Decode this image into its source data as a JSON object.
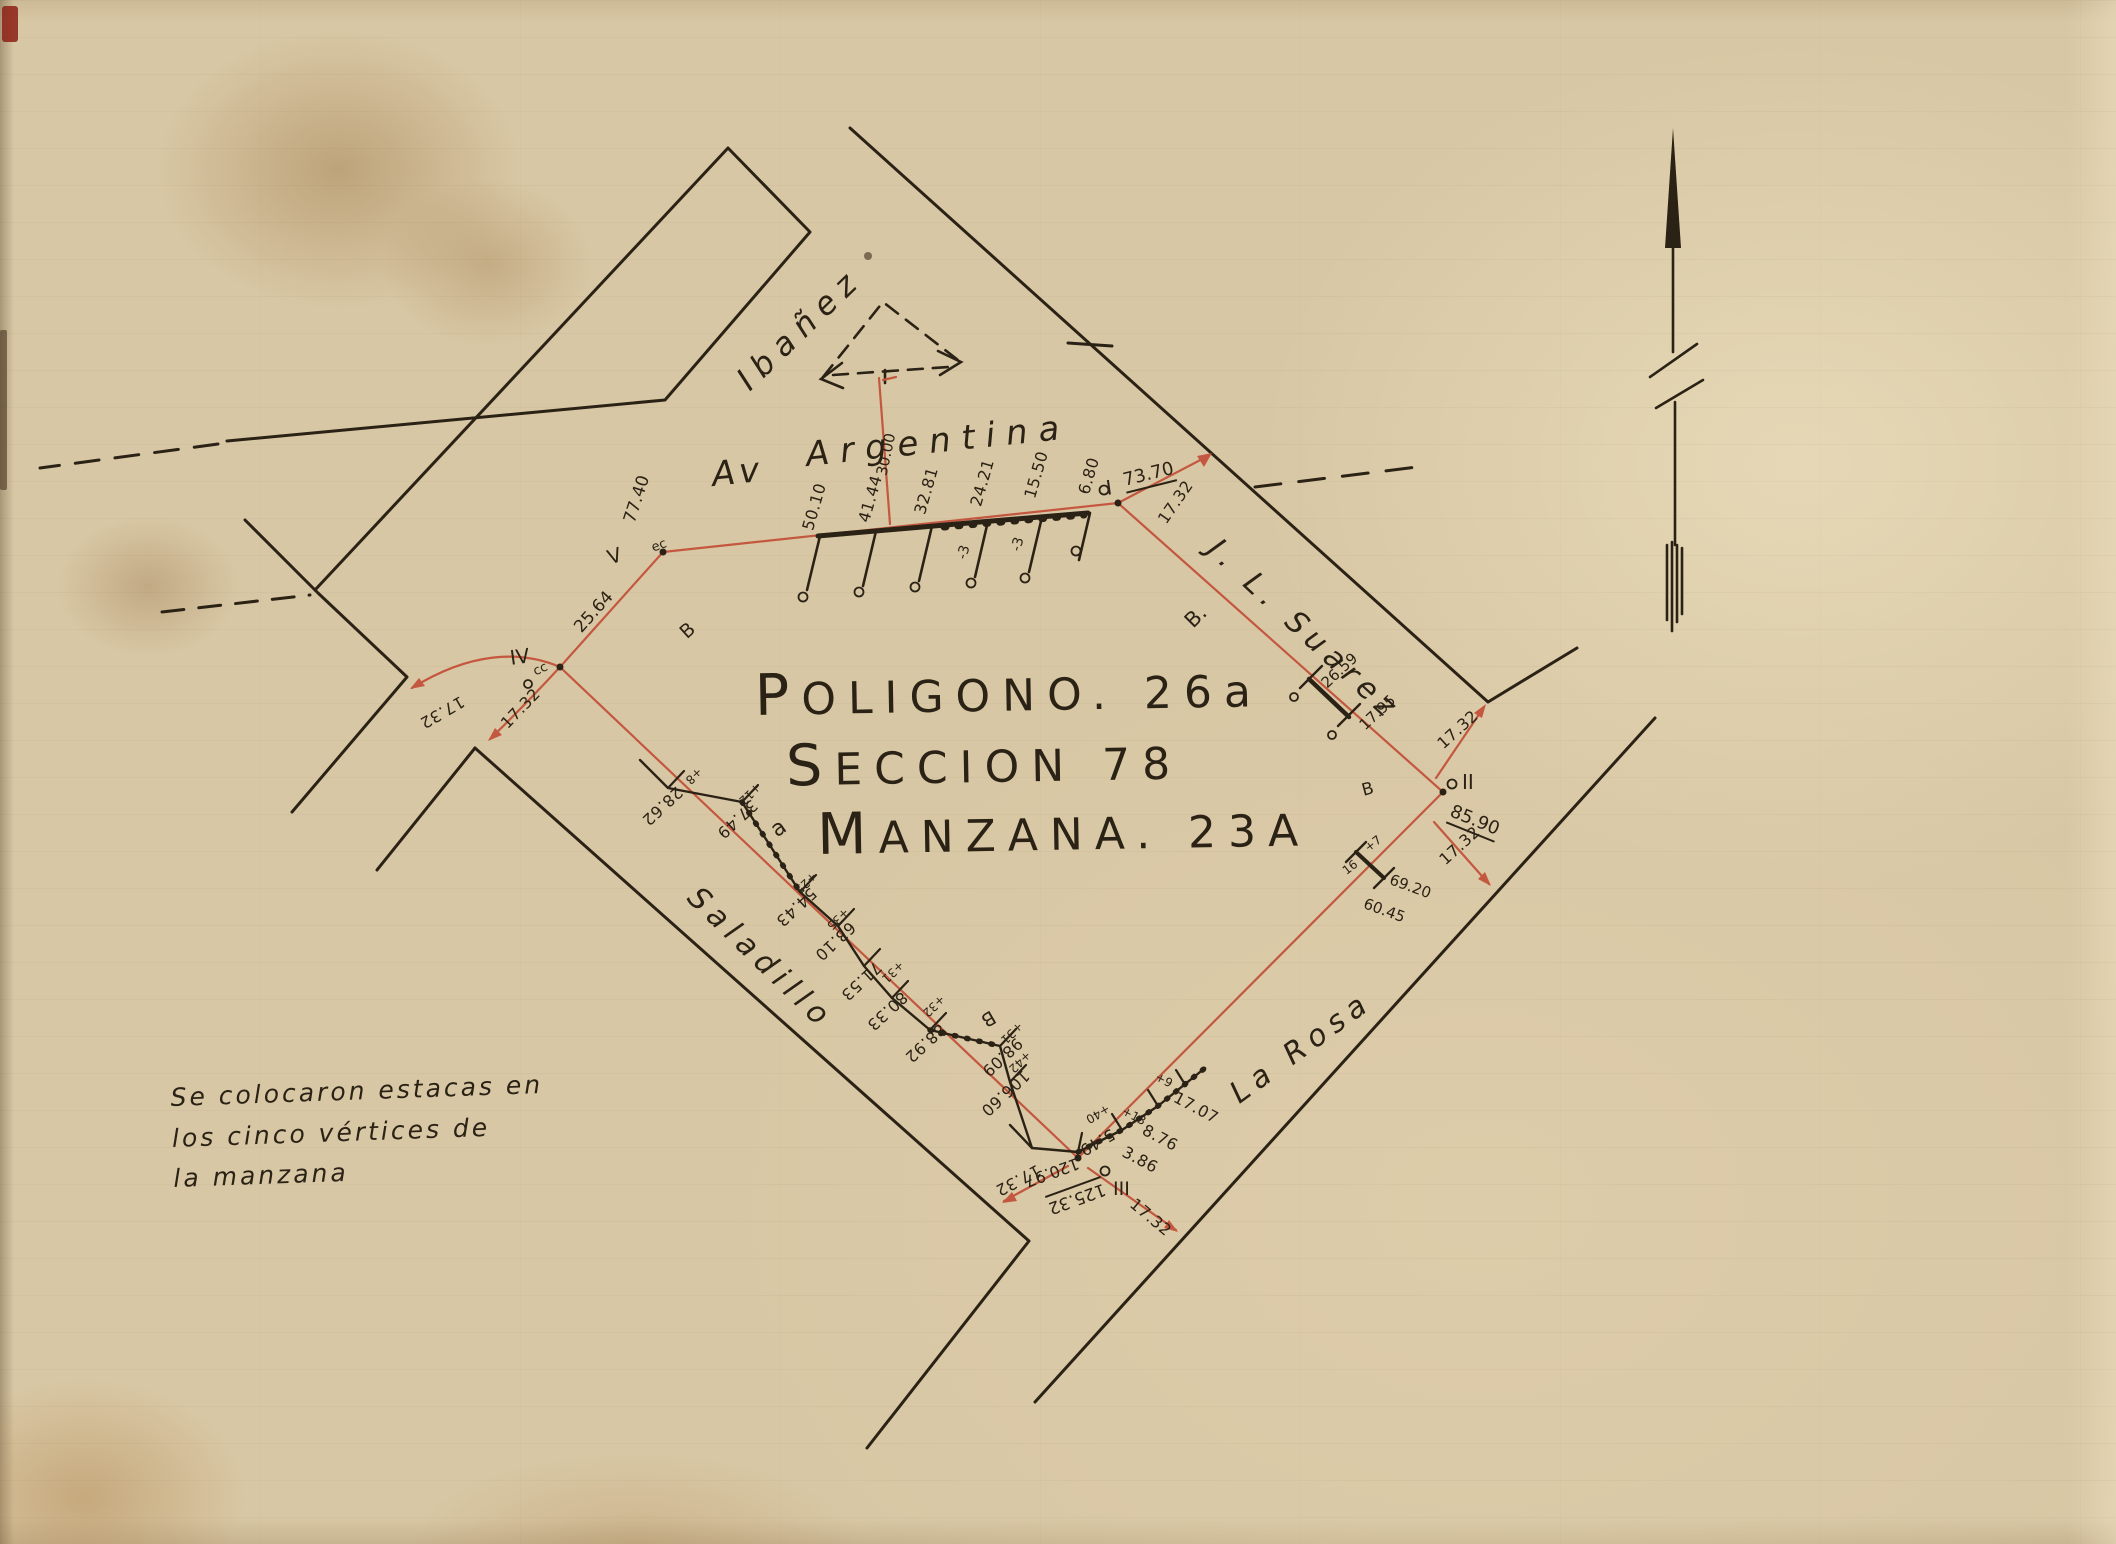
{
  "title": {
    "line1": "POLIGONO. 26a",
    "line2": "SECCION 78",
    "line3": "MANZANA. 23A"
  },
  "streets": {
    "ibanez": "Ibañez",
    "av": "Av",
    "argentina": "Argentina",
    "suarez": "J. L. Suarez",
    "saladillo": "Saladillo",
    "la_rosa": "La Rosa"
  },
  "note": {
    "line1": "Se colocaron estacas en",
    "line2": "los cinco vértices de",
    "line3": "la manzana"
  },
  "vertices": {
    "i": "I",
    "ii": "II",
    "iii": "III",
    "iv": "IV",
    "v": "V"
  },
  "edge_lengths": {
    "at_i": "73.70",
    "at_ii": "85.90",
    "at_iii": "125.32",
    "at_iii_prev": "120.97",
    "at_v": "77.40",
    "iv_v": "25.64"
  },
  "half_width": "17.32",
  "top_ticks": {
    "values": [
      "50.10",
      "41.44",
      "32.81",
      "24.21",
      "15.50",
      "6.80"
    ],
    "minus3_a": "-3",
    "minus3_b": "-3",
    "centerline": "30.00"
  },
  "ne_ticks": {
    "d1": "26.59",
    "d2": "17.95"
  },
  "ii_ticks": {
    "t1": "+7",
    "t2": "16",
    "d1": "69.20",
    "d2": "60.45"
  },
  "sw_chain": [
    {
      "d": "28.62",
      "t": "+8"
    },
    {
      "d": "37.49",
      "t": "+12"
    },
    {
      "d": "54.43",
      "t": "+25"
    },
    {
      "d": "63.10",
      "t": "+35"
    },
    {
      "d": "71.53",
      "t": ""
    },
    {
      "d": "80.33",
      "t": "+31"
    },
    {
      "d": "88.92",
      "t": "+32"
    },
    {
      "d": "98.09",
      "t": "+31"
    },
    {
      "d": "106.60",
      "t": "+42"
    }
  ],
  "iii_chain": {
    "d0": "5.49",
    "t0": "+40",
    "d1": "3.86",
    "d2": "8.76",
    "t2": "+13",
    "d3": "17.07",
    "t3": "+9"
  },
  "marks": {
    "ec": "ec",
    "cc": "cc"
  },
  "block_letters": {
    "b_suarez": "B.",
    "b_ii": "B",
    "b_sw": "B",
    "a_west": "a",
    "b_nw": "B"
  },
  "colors": {
    "paper": "#d8c7a4",
    "ink": "#2b2216",
    "boundary_red": "#c4573f"
  }
}
